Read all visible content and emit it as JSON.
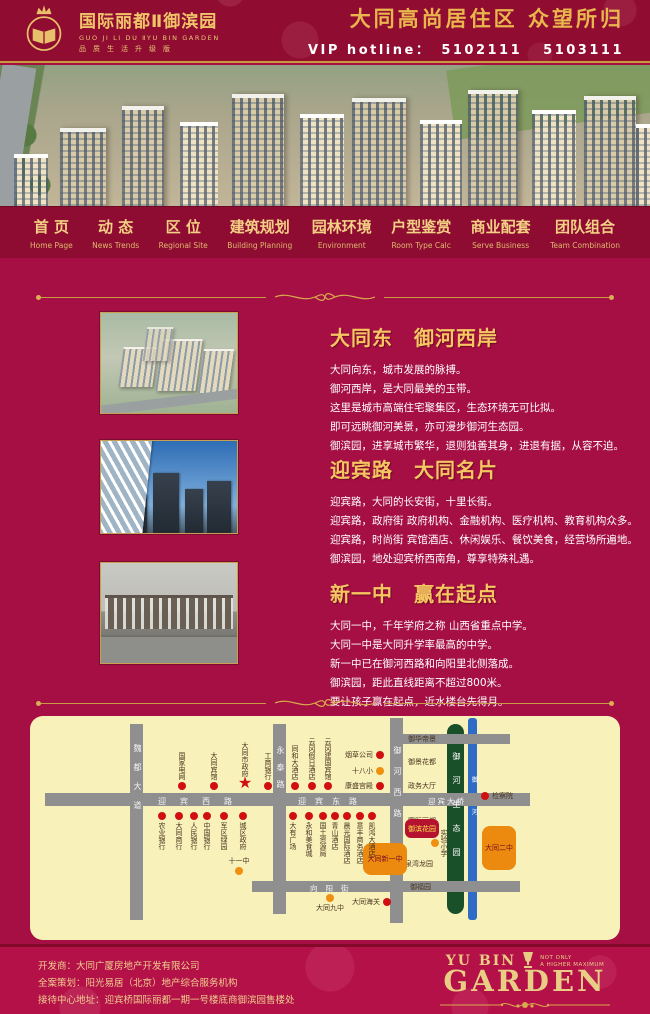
{
  "header": {
    "logo_title": "国际丽都Ⅱ御滨园",
    "logo_subtitle": "GUO JI LI DU ⅡYU BIN GARDEN",
    "logo_tagline": "品质生活升级版",
    "slogan": "大同高尚居住区  众望所归",
    "hotline_label": "VIP hotline：",
    "hotline_numbers": "5102111  5103111",
    "gold": "#e9b64d"
  },
  "nav": {
    "items": [
      {
        "zh": "首  页",
        "en": "Home Page"
      },
      {
        "zh": "动  态",
        "en": "News Trends"
      },
      {
        "zh": "区  位",
        "en": "Regional Site"
      },
      {
        "zh": "建筑规划",
        "en": "Building Planning"
      },
      {
        "zh": "园林环境",
        "en": "Environment"
      },
      {
        "zh": "户型鉴赏",
        "en": "Room Type Calc"
      },
      {
        "zh": "商业配套",
        "en": "Serve Business"
      },
      {
        "zh": "团队组合",
        "en": "Team Combination"
      }
    ]
  },
  "sections": [
    {
      "title": "大同东　御河西岸",
      "lines": [
        "大同向东，城市发展的脉搏。",
        "御河西岸，是大同最美的玉带。",
        "这里是城市高端住宅聚集区，生态环境无可比拟。",
        "即可远眺御河美景，亦可漫步御河生态园。",
        "御滨园，进享城市繁华，退则独善其身，进退有据，从容不迫。"
      ]
    },
    {
      "title": "迎宾路　大同名片",
      "lines": [
        "迎宾路，大同的长安街，十里长街。",
        "迎宾路，政府街 政府机构、金融机构、医疗机构、教育机构众多。",
        "迎宾路，时尚街 宾馆酒店、休闲娱乐、餐饮美食，经营场所遍地。",
        "御滨园，地处迎宾桥西南角，尊享特殊礼遇。"
      ]
    },
    {
      "title": "新一中　赢在起点",
      "lines": [
        "大同一中，千年学府之称 山西省重点中学。",
        "大同一中是大同升学率最高的中学。",
        "新一中已在御河西路和向阳里北侧落成。",
        "御滨园，距此直线距离不超过800米。",
        "要让孩子赢在起点，近水楼台先得月。"
      ]
    }
  ],
  "map": {
    "roads": {
      "west": "迎宾西路",
      "east": "迎宾东路",
      "bridge": "迎宾大桥",
      "south": "向阳街",
      "v1": "魏都大道",
      "v2": "永泰路",
      "v3": "御河西路",
      "park": "御河生态园",
      "river": "御河"
    },
    "marker_colors": {
      "red": "#d01010",
      "orange": "#f09010",
      "project_block": "#b5122f",
      "school_block": "#ec8a10"
    },
    "pois": [
      {
        "t": "red",
        "x": 152,
        "y": 70,
        "lp": "av",
        "label": "国家电网"
      },
      {
        "t": "red",
        "x": 184,
        "y": 70,
        "lp": "av",
        "label": "大同宾馆"
      },
      {
        "t": "star",
        "x": 215,
        "y": 67,
        "lp": "av",
        "label": "大同市政府"
      },
      {
        "t": "red",
        "x": 238,
        "y": 70,
        "lp": "av",
        "label": "工商银行"
      },
      {
        "t": "red",
        "x": 265,
        "y": 70,
        "lp": "av",
        "label": "同和大酒店"
      },
      {
        "t": "red",
        "x": 282,
        "y": 70,
        "lp": "av",
        "label": "云冈假日酒店"
      },
      {
        "t": "red",
        "x": 298,
        "y": 70,
        "lp": "av",
        "label": "云冈建国宾馆"
      },
      {
        "t": "red",
        "x": 350,
        "y": 39,
        "lp": "lh",
        "label": "烟草公司"
      },
      {
        "t": "orange",
        "x": 350,
        "y": 55,
        "lp": "lh",
        "label": "十八小"
      },
      {
        "t": "red",
        "x": 350,
        "y": 70,
        "lp": "lh",
        "label": "康盛宫殿"
      },
      {
        "t": "text",
        "x": 378,
        "y": 10,
        "lp": "plain",
        "label": "御华帝景"
      },
      {
        "t": "text",
        "x": 378,
        "y": 33,
        "lp": "plain",
        "label": "御景花都"
      },
      {
        "t": "text",
        "x": 378,
        "y": 57,
        "lp": "plain",
        "label": "政务大厅"
      },
      {
        "t": "text",
        "x": 378,
        "y": 92,
        "lp": "plain",
        "label": "国际丽都"
      },
      {
        "t": "rblock",
        "x": 375,
        "y": 103,
        "w": 34,
        "h": 19,
        "label": "御滨花园"
      },
      {
        "t": "orange",
        "x": 405,
        "y": 127,
        "lp": "rv",
        "label": "实验小学"
      },
      {
        "t": "text",
        "x": 368,
        "y": 135,
        "lp": "plain",
        "label": "水泉湾龙园"
      },
      {
        "t": "text",
        "x": 380,
        "y": 158,
        "lp": "plain",
        "label": "御福园"
      },
      {
        "t": "red",
        "x": 455,
        "y": 80,
        "lp": "rh",
        "label": "检察院"
      },
      {
        "t": "oblock",
        "x": 452,
        "y": 110,
        "w": 34,
        "h": 44,
        "label": "大同二中"
      },
      {
        "t": "oblock",
        "x": 333,
        "y": 127,
        "w": 44,
        "h": 32,
        "label": "大同新一中"
      },
      {
        "t": "red",
        "x": 132,
        "y": 100,
        "lp": "bv",
        "label": "农业银行"
      },
      {
        "t": "red",
        "x": 149,
        "y": 100,
        "lp": "bv",
        "label": "大同商行"
      },
      {
        "t": "red",
        "x": 164,
        "y": 100,
        "lp": "bv",
        "label": "人民银行"
      },
      {
        "t": "red",
        "x": 177,
        "y": 100,
        "lp": "bv",
        "label": "中国银行"
      },
      {
        "t": "red",
        "x": 194,
        "y": 100,
        "lp": "bv",
        "label": "军区绿园"
      },
      {
        "t": "red",
        "x": 213,
        "y": 100,
        "lp": "bv",
        "label": "城区政府"
      },
      {
        "t": "red",
        "x": 263,
        "y": 100,
        "lp": "bv",
        "label": "大有广场"
      },
      {
        "t": "red",
        "x": 279,
        "y": 100,
        "lp": "bv",
        "label": "永和美食城"
      },
      {
        "t": "red",
        "x": 293,
        "y": 100,
        "lp": "bv",
        "label": "国土资源局"
      },
      {
        "t": "red",
        "x": 305,
        "y": 100,
        "lp": "bv",
        "label": "青山酒店"
      },
      {
        "t": "red",
        "x": 317,
        "y": 100,
        "lp": "bv",
        "label": "晨光国际酒店"
      },
      {
        "t": "red",
        "x": 330,
        "y": 100,
        "lp": "bv",
        "label": "意丰商务酒店"
      },
      {
        "t": "red",
        "x": 342,
        "y": 100,
        "lp": "bv",
        "label": "凯鸿大酒店"
      },
      {
        "t": "orange",
        "x": 209,
        "y": 155,
        "lp": "ah",
        "label": "十一中"
      },
      {
        "t": "orange",
        "x": 300,
        "y": 182,
        "lp": "bh",
        "label": "大同九中"
      },
      {
        "t": "red",
        "x": 357,
        "y": 186,
        "lp": "lh",
        "label": "大同海关"
      }
    ]
  },
  "footer": {
    "lines": [
      "开发商：大同广厦房地产开发有限公司",
      "全案策划：阳光易居（北京）地产综合服务机构",
      "接待中心地址：迎宾桥国际丽都一期一号楼底商御滨园售楼处"
    ],
    "brand_yubin": "YU BIN",
    "brand_tag1": "NOT ONLY",
    "brand_tag2": "A  HIGHER  MAXIMUM",
    "brand_main": "GARDEN"
  }
}
